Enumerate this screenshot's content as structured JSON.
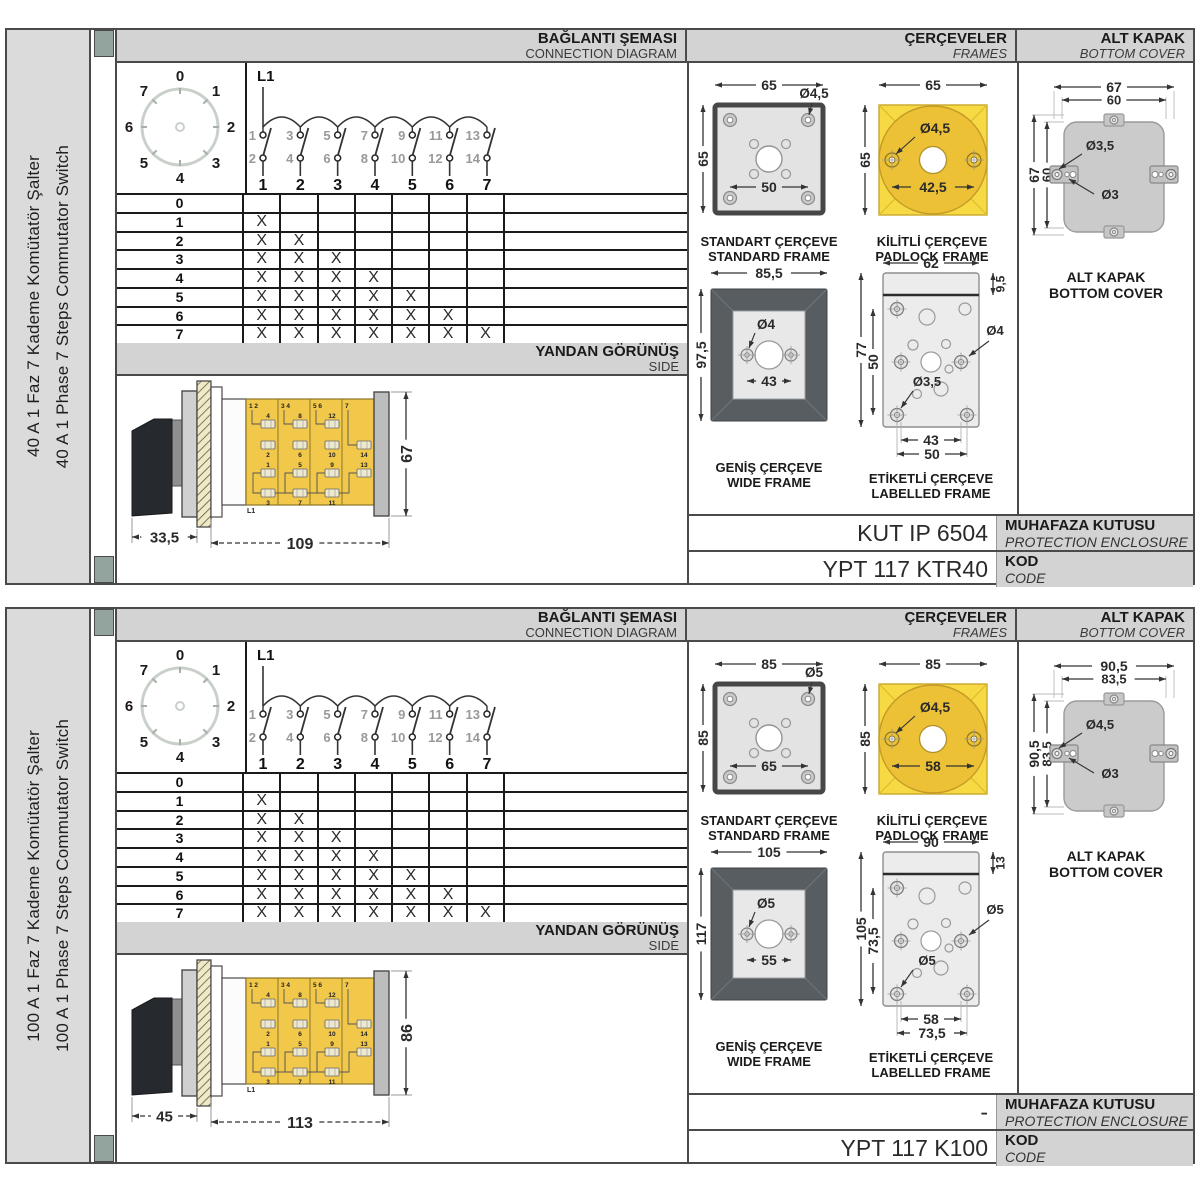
{
  "shared": {
    "headers": {
      "connection": {
        "tr": "BAĞLANTI ŞEMASI",
        "en": "CONNECTION DIAGRAM"
      },
      "frames": {
        "tr": "ÇERÇEVELER",
        "en": "FRAMES"
      },
      "bottom_cover": {
        "tr": "ALT KAPAK",
        "en": "BOTTOM COVER"
      },
      "side": {
        "tr": "YANDAN GÖRÜNÜŞ",
        "en": "SIDE"
      },
      "enclosure": {
        "tr": "MUHAFAZA KUTUSU",
        "en": "PROTECTION ENCLOSURE"
      },
      "code": {
        "tr": "KOD",
        "en": "CODE"
      }
    },
    "dial": {
      "positions": [
        "0",
        "1",
        "2",
        "3",
        "4",
        "5",
        "6",
        "7"
      ]
    },
    "circuit": {
      "input": "L1",
      "top_contacts": [
        "1",
        "3",
        "5",
        "7",
        "9",
        "11",
        "13"
      ],
      "bottom_contacts": [
        "2",
        "4",
        "6",
        "8",
        "10",
        "12",
        "14"
      ],
      "columns": [
        "1",
        "2",
        "3",
        "4",
        "5",
        "6",
        "7"
      ]
    },
    "step_table": {
      "row_labels": [
        "0",
        "1",
        "2",
        "3",
        "4",
        "5",
        "6",
        "7"
      ],
      "mark": "X",
      "marks_per_row": [
        0,
        1,
        2,
        3,
        4,
        5,
        6,
        7
      ],
      "columns": 7
    },
    "frame_captions": {
      "standard": {
        "tr": "STANDART ÇERÇEVE",
        "en": "STANDARD FRAME"
      },
      "padlock": {
        "tr": "KİLİTLİ ÇERÇEVE",
        "en": "PADLOCK FRAME"
      },
      "wide": {
        "tr": "GENİŞ ÇERÇEVE",
        "en": "WIDE FRAME"
      },
      "labelled": {
        "tr": "ETİKETLİ ÇERÇEVE",
        "en": "LABELLED FRAME"
      },
      "cover": {
        "tr": "ALT KAPAK",
        "en": "BOTTOM COVER"
      }
    },
    "side_terminals": {
      "corner_labels": [
        "1  2",
        "3  4",
        "5  6",
        "7"
      ],
      "upper_top_boxes": [
        "4",
        "8",
        "12",
        ""
      ],
      "upper_bottom_boxes": [
        "2",
        "6",
        "10",
        "14"
      ],
      "lower_top_boxes": [
        "1",
        "5",
        "9",
        "13"
      ],
      "lower_bottom_boxes": [
        "3",
        "7",
        "11",
        ""
      ],
      "input": "L1"
    },
    "colors": {
      "panel_header": "#d3d3d3",
      "sidebar": "#dbdbdb",
      "binder_mark": "#93a49e",
      "frame_yellow": "#f7d943",
      "padlock_circle": "#ecc136",
      "switch_body_yellow": "#f2c84b",
      "wide_frame_dark": "#575d61",
      "plate_gray": "#e3e3e3",
      "cover_gray": "#cbcbcb",
      "line_dark": "#4a4a4a"
    }
  },
  "sections": [
    {
      "title_tr": "40 A 1 Faz 7 Kademe Komütatör Şalter",
      "title_en": "40 A 1 Phase 7 Steps Commutator Switch",
      "side_view": {
        "depth": "33,5",
        "length": "109",
        "height": "67"
      },
      "standard_frame": {
        "width": "65",
        "height": "65",
        "hole": "Ø4,5",
        "pitch": "50"
      },
      "padlock_frame": {
        "width": "65",
        "height": "65",
        "hole": "Ø4,5",
        "pitch": "42,5"
      },
      "wide_frame": {
        "width": "85,5",
        "height": "97,5",
        "hole": "Ø4",
        "pitch": "43"
      },
      "labelled_frame": {
        "width": "62",
        "strip": "9,5",
        "height": "77",
        "inner_height": "50",
        "hole_right": "Ø4",
        "hole_left": "Ø3,5",
        "pitch_inner": "43",
        "pitch_outer": "50"
      },
      "bottom_cover": {
        "outer_width": "67",
        "inner_width": "60",
        "outer_height": "67",
        "inner_height": "60",
        "hole_big": "Ø3,5",
        "hole_small": "Ø3"
      },
      "enclosure": "KUT IP 6504",
      "code": "YPT 117 KTR40"
    },
    {
      "title_tr": "100 A 1 Faz 7 Kademe Komütatör Şalter",
      "title_en": "100 A 1 Phase 7 Steps Commutator Switch",
      "side_view": {
        "depth": "45",
        "length": "113",
        "height": "86"
      },
      "standard_frame": {
        "width": "85",
        "height": "85",
        "hole": "Ø5",
        "pitch": "65"
      },
      "padlock_frame": {
        "width": "85",
        "height": "85",
        "hole": "Ø4,5",
        "pitch": "58"
      },
      "wide_frame": {
        "width": "105",
        "height": "117",
        "hole": "Ø5",
        "pitch": "55"
      },
      "labelled_frame": {
        "width": "90",
        "strip": "13",
        "height": "105",
        "inner_height": "73,5",
        "hole_right": "Ø5",
        "hole_left": "Ø5",
        "pitch_inner": "58",
        "pitch_outer": "73,5"
      },
      "bottom_cover": {
        "outer_width": "90,5",
        "inner_width": "83,5",
        "outer_height": "90,5",
        "inner_height": "83,5",
        "hole_big": "Ø4,5",
        "hole_small": "Ø3"
      },
      "enclosure": "-",
      "code": "YPT 117 K100"
    }
  ]
}
